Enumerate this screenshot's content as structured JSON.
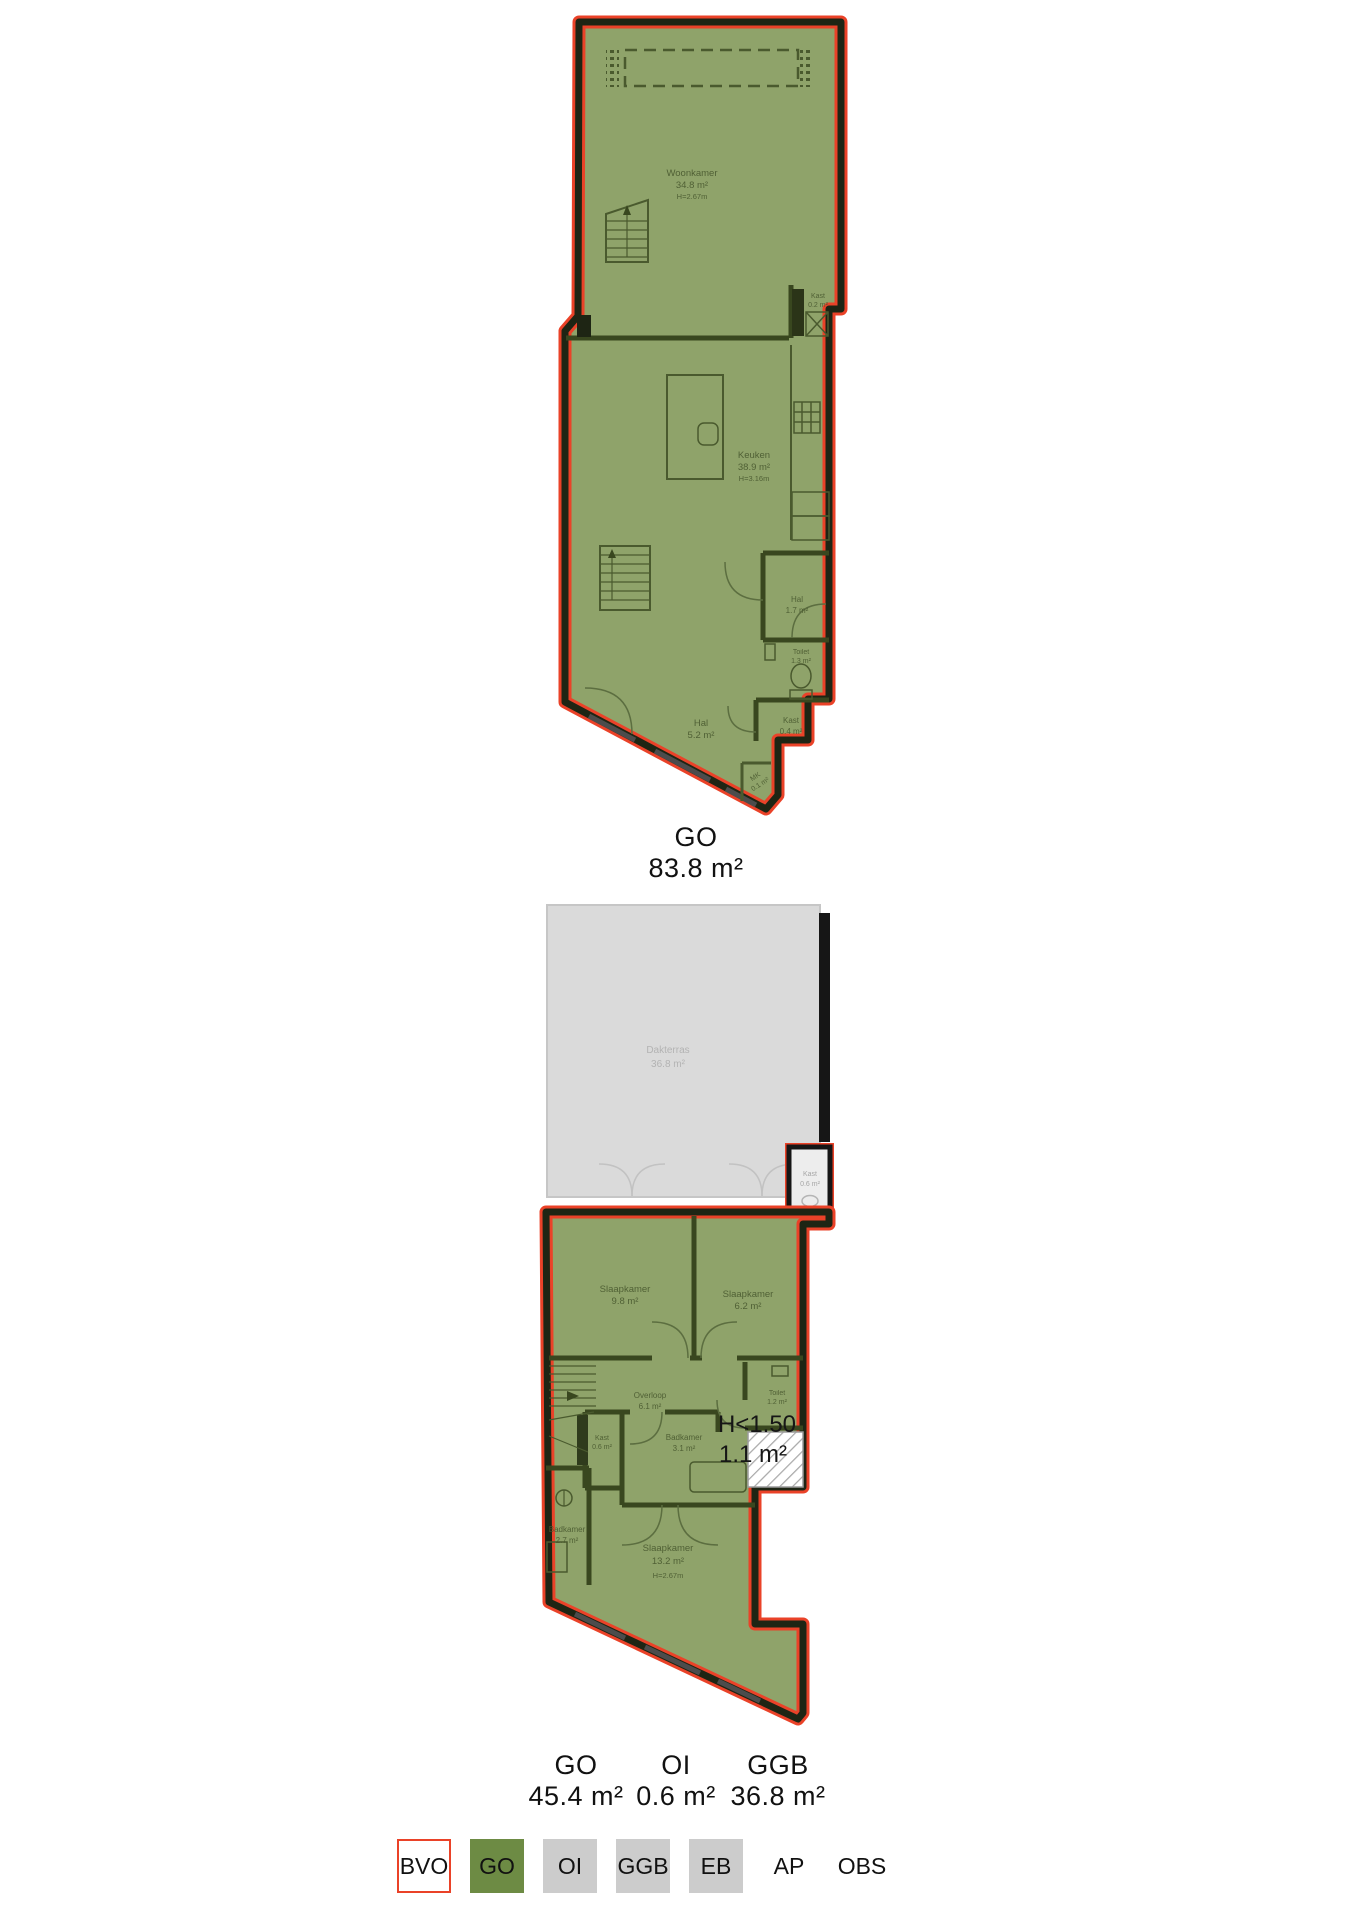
{
  "floor1": {
    "caption": {
      "label": "GO",
      "value": "83.8 m²"
    },
    "rooms": {
      "woonkamer": {
        "name": "Woonkamer",
        "area": "34.8 m²",
        "height": "H=2.67m"
      },
      "keuken": {
        "name": "Keuken",
        "area": "38.9 m²",
        "height": "H=3.16m"
      },
      "kast_top": {
        "name": "Kast",
        "area": "0.2 m²"
      },
      "hal_small": {
        "name": "Hal",
        "area": "1.7 m²"
      },
      "toilet": {
        "name": "Toilet",
        "area": "1.3 m²"
      },
      "hal_large": {
        "name": "Hal",
        "area": "5.2 m²"
      },
      "kast_bottom": {
        "name": "Kast",
        "area": "0.4 m²"
      },
      "mk": {
        "name": "MK",
        "area": "0.1 m²"
      }
    }
  },
  "floor2": {
    "captions": [
      {
        "label": "GO",
        "value": "45.4 m²"
      },
      {
        "label": "OI",
        "value": "0.6 m²"
      },
      {
        "label": "GGB",
        "value": "36.8 m²"
      }
    ],
    "rooms": {
      "dakterras": {
        "name": "Dakterras",
        "area": "36.8 m²"
      },
      "kast_terras": {
        "name": "Kast",
        "area": "0.6 m²"
      },
      "slaapkamer_1": {
        "name": "Slaapkamer",
        "area": "9.8 m²"
      },
      "slaapkamer_2": {
        "name": "Slaapkamer",
        "area": "6.2 m²"
      },
      "overloop": {
        "name": "Overloop",
        "area": "6.1 m²"
      },
      "toilet": {
        "name": "Toilet",
        "area": "1.2 m²"
      },
      "low_height": {
        "name": "H<1.50",
        "area": "1.1 m²"
      },
      "kast": {
        "name": "Kast",
        "area": "0.6 m²"
      },
      "badkamer_1": {
        "name": "Badkamer",
        "area": "3.1 m²"
      },
      "badkamer_2": {
        "name": "Badkamer",
        "area": "2.7 m²"
      },
      "slaapkamer_3": {
        "name": "Slaapkamer",
        "area": "13.2 m²",
        "height": "H=2.67m"
      }
    }
  },
  "legend": {
    "items": [
      {
        "label": "BVO",
        "swatch": "outline",
        "fill": "#ffffff",
        "border": "#ea4228"
      },
      {
        "label": "GO",
        "swatch": "fill",
        "fill": "#6d8b44"
      },
      {
        "label": "OI",
        "swatch": "fill",
        "fill": "#cccccc"
      },
      {
        "label": "GGB",
        "swatch": "fill",
        "fill": "#cccccc"
      },
      {
        "label": "EB",
        "swatch": "fill",
        "fill": "#cccccc"
      },
      {
        "label": "AP",
        "swatch": "none"
      },
      {
        "label": "OBS",
        "swatch": "none"
      }
    ]
  },
  "colors": {
    "bvo_outline": "#ea4228",
    "go_plan_fill": "#8fa36a",
    "plan_wall": "#1e2514",
    "interior_line": "#4a5a2e",
    "terrace_fill": "#dadada",
    "legend_go": "#6d8b44",
    "legend_grey": "#cccccc",
    "low_height_text": "#161616"
  }
}
